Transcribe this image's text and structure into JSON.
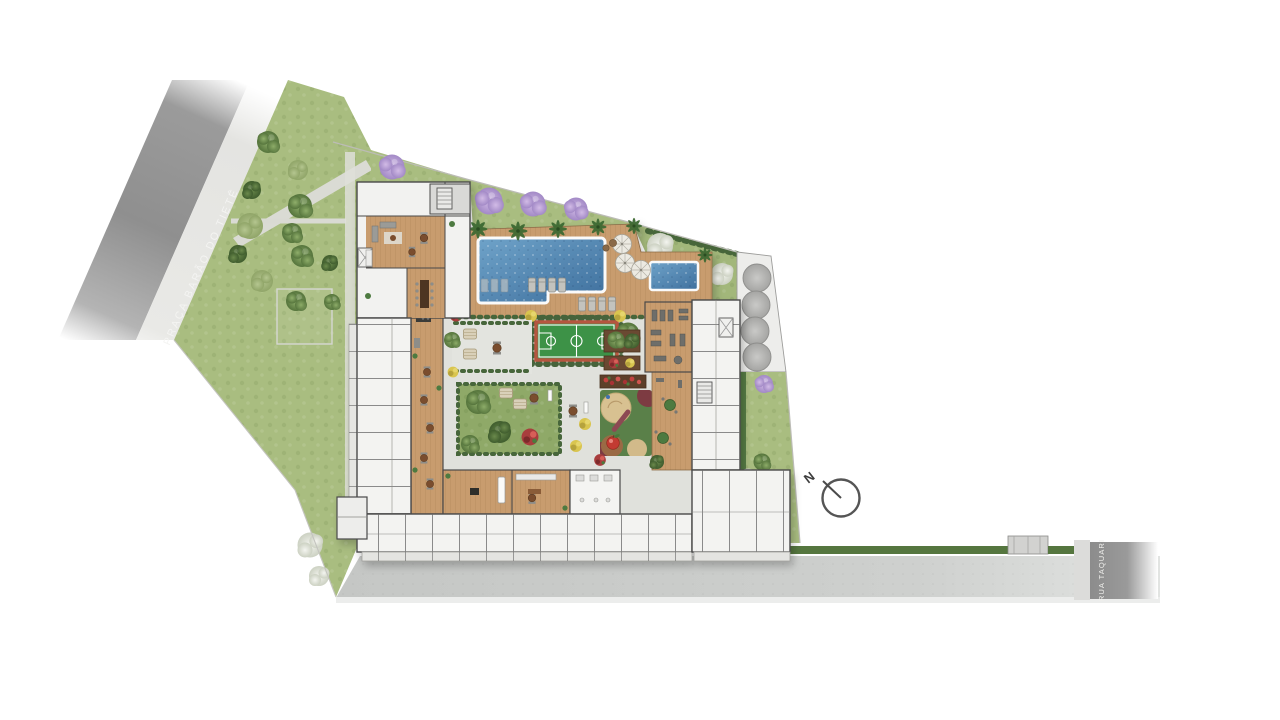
{
  "plan": {
    "type": "residential-site-plan-top-view",
    "streets": {
      "left": "PRAÇA BARÃO DO TIETÊ",
      "right": "RUA TAQUARI"
    },
    "compass": {
      "north_label": "N"
    },
    "counts": {
      "water_tanks": 4,
      "pool_umbrellas": 3,
      "purple_trees_on_top_lawn": 3
    },
    "features": [
      "public-square-park-with-trees",
      "perimeter-residential-building-ring",
      "central-courtyard-gardens",
      "swimming-pool-with-wood-deck",
      "kids-pool",
      "sun-loungers",
      "pool-umbrellas",
      "multi-sport-court",
      "playground",
      "gym",
      "barbecue-pergola-gardens",
      "water-tanks",
      "rear-driveway",
      "compass-north-arrow"
    ],
    "palette": {
      "background": "#ffffff",
      "road": "#8f8f8f",
      "sidewalk": "#e3e3e0",
      "lawn": "#a9bd80",
      "deck_wood": "#c89c6e",
      "pool_water": "#4e7fae",
      "court_green": "#3c9247",
      "court_border": "#b5563f",
      "playground_rubber": "#5a8049",
      "sand": "#d8c191",
      "building_floor": "#f2f2f0",
      "wall": "#4a4a4a",
      "tank_gray": "#b5b5b3",
      "tree_purple": "#b49bd1",
      "tree_white": "#e9ebe3"
    }
  }
}
